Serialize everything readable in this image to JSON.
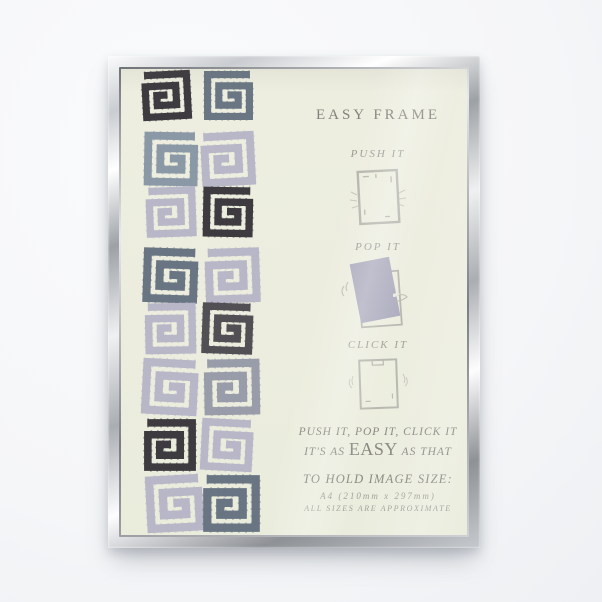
{
  "scene": {
    "description": "silver easy-open photo frame product shot",
    "background_color": "#f5f6f8"
  },
  "frame": {
    "material": "chrome silver",
    "colors": {
      "highlight": "#ffffff",
      "light": "#e9eaec",
      "mid": "#aaadb2",
      "dark": "#85888d"
    }
  },
  "insert": {
    "paper_color": "#edeee0",
    "text_color": "#82827a",
    "text_color_light": "#9a9a92",
    "sketch_color": "#b5b5ad",
    "pop_paper_color": "#abaabd",
    "title": "EASY FRAME",
    "steps": [
      {
        "label": "PUSH IT",
        "icon": "push-frame-icon"
      },
      {
        "label": "POP IT",
        "icon": "pop-paper-icon"
      },
      {
        "label": "CLICK IT",
        "icon": "click-frame-icon"
      }
    ],
    "tagline": {
      "line1": "PUSH IT, POP IT, CLICK IT",
      "line2_prefix": "IT'S AS ",
      "line2_emphasis": "EASY",
      "line2_suffix": " AS THAT"
    },
    "size_info": {
      "heading": "TO HOLD IMAGE SIZE:",
      "value": "A4  (210mm x 297mm)",
      "note": "ALL SIZES ARE APPROXIMATE"
    }
  },
  "pattern": {
    "motif": "brushed square spiral",
    "colors": {
      "black": "#37343a",
      "charcoal": "#4c4a50",
      "steel": "#64717f",
      "slate": "#8895a4",
      "gray": "#969aa8",
      "lavender": "#b6b5c8"
    },
    "grid": [
      [
        "black",
        "steel"
      ],
      [
        "slate",
        "lavender"
      ],
      [
        "lavender",
        "black"
      ],
      [
        "steel",
        "lavender"
      ],
      [
        "lavender",
        "charcoal"
      ],
      [
        "lavender",
        "gray"
      ],
      [
        "black",
        "lavender"
      ],
      [
        "lavender",
        "steel"
      ]
    ]
  }
}
